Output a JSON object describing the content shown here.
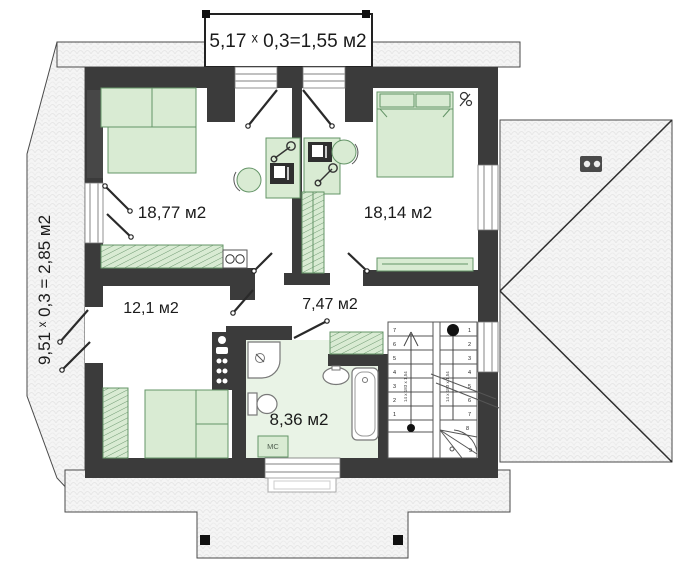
{
  "plan": {
    "dormer_dimension_label": "5,17 ˣ 0,3=1,55 м2",
    "side_dimension_label": "9,51 ˣ 0,3 = 2,85 м2",
    "rooms": [
      {
        "name": "bedroom-top-left",
        "area_label": "18,77 м2"
      },
      {
        "name": "bedroom-top-right",
        "area_label": "18,14 м2"
      },
      {
        "name": "bedroom-bottom-left",
        "area_label": "12,1 м2"
      },
      {
        "name": "hallway",
        "area_label": "7,47 м2"
      },
      {
        "name": "bathroom",
        "area_label": "8,36 м2"
      }
    ],
    "appliance_labels": {
      "washing_machine": "МС"
    },
    "stairs": {
      "left_flight_numbers": [
        "7",
        "6",
        "5",
        "4",
        "3",
        "2",
        "1"
      ],
      "right_flight_numbers": [
        "1",
        "2",
        "3",
        "4",
        "5",
        "6",
        "7",
        "8",
        "9"
      ],
      "flight_annotation_left": "14 x 183 x 1,54",
      "flight_annotation_right": "14 x 183 x 1,54"
    },
    "colors": {
      "wall": "#3b3b3b",
      "furniture_fill": "#d9ebd3",
      "furniture_stroke": "#649467",
      "bathroom_floor": "#e9f3e6",
      "roof_fill": "#f5f5f5",
      "line": "#444444"
    }
  }
}
